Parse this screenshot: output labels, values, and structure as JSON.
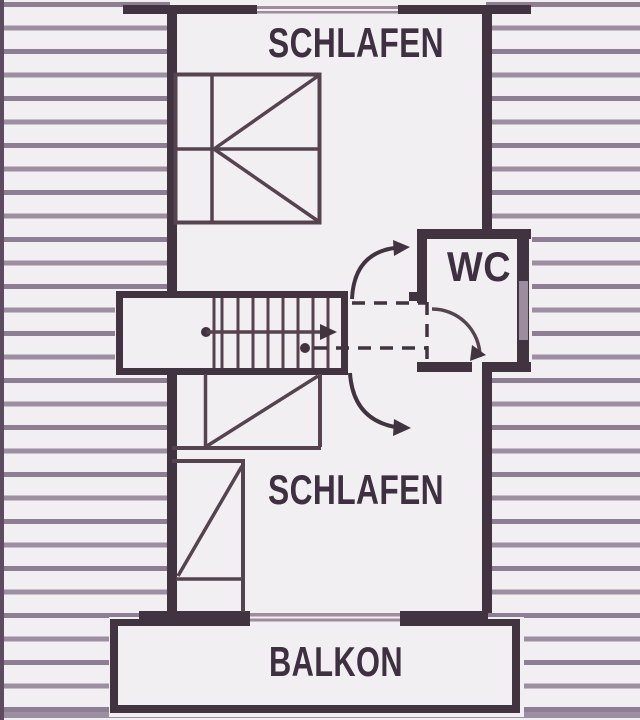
{
  "floorplan": {
    "labels": {
      "bedroom_top": "SCHLAFEN",
      "wc": "WC",
      "bedroom_bottom": "SCHLAFEN",
      "balcony": "BALKON"
    },
    "colors": {
      "paper": "#f2eff2",
      "wall": "#41333f",
      "furniture_line": "#554350",
      "hatch_stripe": "#8e7e94",
      "hatch_stripe_alt": "#9e8ea2",
      "window_line": "#9c8c9e",
      "label_text": "#3e3040"
    }
  }
}
